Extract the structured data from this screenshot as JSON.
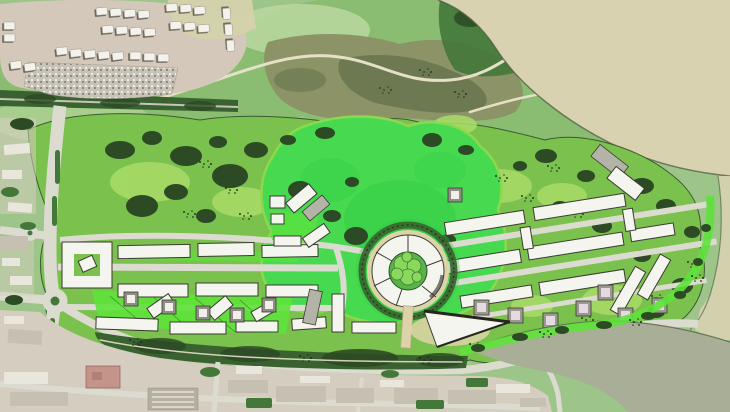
{
  "scene": {
    "kind": "aerial-masterplan-map",
    "features": [
      "housing-estate",
      "informal-settlement",
      "north-fields",
      "marsh",
      "coastal-headland",
      "estuary-water",
      "inlet-water",
      "masterplan-site",
      "central-lawn",
      "left-building-cluster",
      "west-center-cluster",
      "right-building-cluster",
      "circular-courtyard-building",
      "triangle-building",
      "south-tree-belt",
      "road-network",
      "roundabout",
      "mini-roundabout",
      "bottom-urban-strip",
      "left-urban-strip",
      "parking-lot",
      "red-roof-building",
      "shore-band"
    ]
  },
  "palette": {
    "base_green": "#9dc489",
    "field_green": "#8abc72",
    "field_light": "#bcdaa2",
    "estate_ground": "#d3c8b9",
    "settlement": "#c8c3b8",
    "water_estuary": "#d8d2b1",
    "water_inlet": "#a9ae96",
    "marsh_olive": "#8b9367",
    "marsh_dark": "#66744d",
    "park_green": "#7bc14e",
    "park_light": "#a9dc68",
    "lawn_vivid": "#47da51",
    "lawn_deep": "#2fc944",
    "garden_bright": "#5ee23a",
    "tree_dark": "#2c4a24",
    "tree_mid": "#44783a",
    "tree_belt": "#3a6230",
    "road_light": "#dbdbd0",
    "road_mid": "#c4c4b8",
    "path_tan": "#ddd3a8",
    "trail_tan": "#e6e0c6",
    "building_white": "#f5f5ef",
    "building_roof": "#e2e2d8",
    "building_gray": "#b3b3a8",
    "building_stroke": "#3b3b33",
    "shadow_dark": "#26261f",
    "urban_tan": "#d5cec0",
    "urban_block": "#c6c0b2",
    "urban_white": "#e9e6dc",
    "roof_red": "#c4948a",
    "core_pink": "#e6dae2",
    "dark_line": "#4a5a3a"
  }
}
